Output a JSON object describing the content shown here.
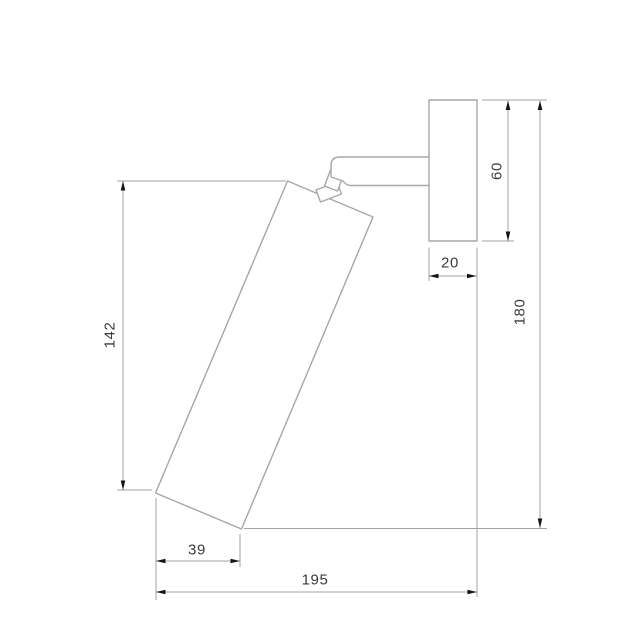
{
  "colors": {
    "background": "#ffffff",
    "object_line": "#a3a8a8",
    "dimension_line": "#9fa4a4",
    "arrow": "#141414",
    "label_text": "#3b3b3b"
  },
  "dimensions": {
    "body_length": "142",
    "plate_height": "60",
    "plate_depth": "20",
    "overall_height": "180",
    "body_bottom_offset": "39",
    "overall_depth": "195"
  }
}
